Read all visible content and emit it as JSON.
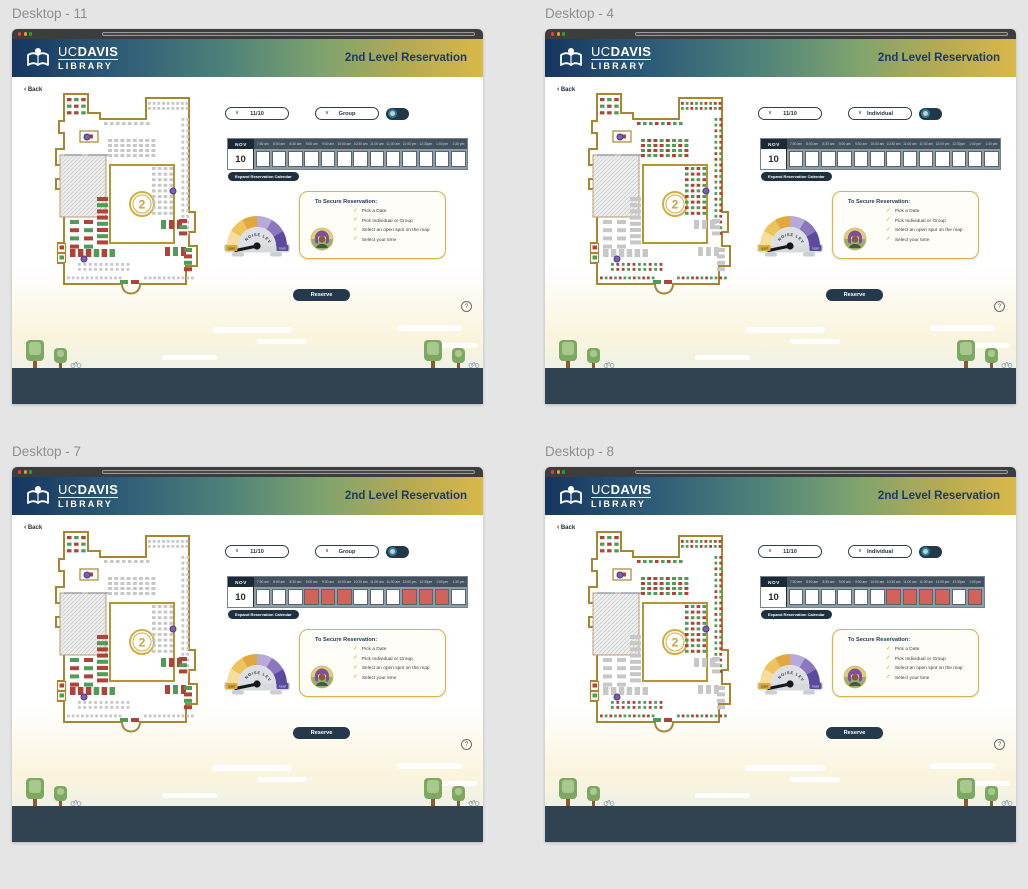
{
  "canvas": {
    "background": "#e5e5e5"
  },
  "frames": [
    {
      "label": "Desktop - 11",
      "date": "11/10",
      "mode": "Group",
      "map_mode": "group",
      "calendar": {
        "month": "NOV",
        "day": "10",
        "times": [
          "7:30 am",
          "8:00 am",
          "8:30 am",
          "9:00 am",
          "9:30 am",
          "10:00 am",
          "10:30 am",
          "11:00 am",
          "11:30 am",
          "12:00 pm",
          "12:30pm",
          "1:00 pm",
          "1:30 pm"
        ],
        "slots": [
          "open",
          "open",
          "open",
          "open",
          "open",
          "open",
          "open",
          "open",
          "open",
          "open",
          "open",
          "open",
          "open"
        ]
      }
    },
    {
      "label": "Desktop - 4",
      "date": "11/10",
      "mode": "Individual",
      "map_mode": "individual",
      "calendar": {
        "month": "NOV",
        "day": "10",
        "times": [
          "7:30 am",
          "8:00 am",
          "8:30 am",
          "9:00 am",
          "9:30 am",
          "10:00 am",
          "10:30 am",
          "11:00 am",
          "11:30 am",
          "12:00 pm",
          "12:30pm",
          "1:00 pm",
          "1:30 pm"
        ],
        "slots": [
          "open",
          "open",
          "open",
          "open",
          "open",
          "open",
          "open",
          "open",
          "open",
          "open",
          "open",
          "open",
          "open"
        ]
      }
    },
    {
      "label": "Desktop - 7",
      "date": "11/10",
      "mode": "Group",
      "map_mode": "group",
      "calendar": {
        "month": "NOV",
        "day": "10",
        "times": [
          "7:30 am",
          "8:00 am",
          "8:30 am",
          "9:00 am",
          "9:30 am",
          "10:00 am",
          "10:30 am",
          "11:00 am",
          "11:30 am",
          "12:00 pm",
          "12:30pm",
          "1:00 pm",
          "1:30 pm"
        ],
        "slots": [
          "open",
          "open",
          "open",
          "booked",
          "booked",
          "booked",
          "open",
          "open",
          "open",
          "booked",
          "booked",
          "booked",
          "open"
        ]
      }
    },
    {
      "label": "Desktop - 8",
      "date": "11/10",
      "mode": "Individual",
      "map_mode": "individual",
      "calendar": {
        "month": "NOV",
        "day": "10",
        "times": [
          "7:30 am",
          "8:00 am",
          "8:30 am",
          "9:00 am",
          "9:30 am",
          "10:00 am",
          "10:30 am",
          "11:00 am",
          "11:30 am",
          "12:00 pm",
          "12:30pm",
          "1:00 pm"
        ],
        "slots": [
          "open",
          "open",
          "open",
          "open",
          "open",
          "open",
          "booked",
          "booked",
          "booked",
          "booked",
          "open",
          "booked"
        ]
      }
    }
  ],
  "shared": {
    "header": {
      "brand_top_regular": "UC",
      "brand_top_bold": "DAVIS",
      "brand_bottom": "LIBRARY",
      "page_title": "2nd Level Reservation"
    },
    "back": {
      "chevron": "‹",
      "label": "Back"
    },
    "controls": {
      "chevron": "∨"
    },
    "calendar_expand_label": "Expand Reservation Calendar",
    "gauge": {
      "title": "NOISE LEVEL",
      "min_label": "quiet",
      "max_label": "loud"
    },
    "instructions": {
      "title": "To Secure Reservation:",
      "check_glyph": "✓",
      "items": [
        "Pick a Date",
        "Pick Individual or Group",
        "Select an open spot on the map",
        "Select your time"
      ]
    },
    "reserve_label": "Reserve",
    "help_glyph": "?",
    "map_level": "2"
  },
  "colors": {
    "header_gradient": [
      "#16365f",
      "#4f8379",
      "#d9b84a"
    ],
    "accent_navy": "#24394b",
    "gold_border": "#d8b349",
    "booked_slot": "#d2635b",
    "seat_open": "#4f9c57",
    "seat_taken": "#b04237",
    "seat_unavailable": "#c7c7c7",
    "marker_purple": "#7b5fb5",
    "gauge_yellows": [
      "#f6dd9b",
      "#eec35c",
      "#e2a83e"
    ],
    "gauge_purples": [
      "#b7a9d8",
      "#8a77bd",
      "#5c4a9f"
    ],
    "traffic_lights": [
      "#e0443e",
      "#dfa123",
      "#25a52f"
    ]
  },
  "map": {
    "seat_colors": {
      "r": "#b04237",
      "g": "#4f9c57",
      "x": "#c7c7c7"
    },
    "markers": [
      {
        "x": 53,
        "y": 46
      },
      {
        "x": 139,
        "y": 100
      },
      {
        "x": 50,
        "y": 168
      }
    ],
    "clusters": [
      {
        "name": "tab-cluster",
        "cat": "always",
        "x": 33,
        "y": 7,
        "cols": 3,
        "rows": 3,
        "w": 4.5,
        "h": 3.2,
        "gx": 2.6,
        "gy": 3.4,
        "pat": "rgrgrgrrg"
      },
      {
        "name": "closet-seat",
        "cat": "always",
        "x": 50,
        "y": 43.5,
        "cols": 1,
        "rows": 1,
        "w": 9,
        "h": 4,
        "gx": 0,
        "gy": 0,
        "pat": "r"
      },
      {
        "name": "elevator-seats",
        "cat": "always",
        "x": 25.5,
        "y": 154.5,
        "cols": 1,
        "rows": 2,
        "w": 4.5,
        "h": 4,
        "gx": 0,
        "gy": 6,
        "pat": "rg"
      },
      {
        "name": "top-row",
        "cat": "individual",
        "x": 114,
        "y": 11,
        "cols": 9,
        "rows": 2,
        "w": 2.8,
        "h": 2.8,
        "gx": 1.9,
        "gy": 2.2,
        "pat": "rgrggrgrrggrgrgrgr"
      },
      {
        "name": "upper-row",
        "cat": "individual",
        "x": 70,
        "y": 31,
        "cols": 8,
        "rows": 1,
        "w": 3.6,
        "h": 3,
        "gx": 2.4,
        "gy": 0,
        "pat": "rggrgrgg"
      },
      {
        "name": "right-col",
        "cat": "individual",
        "x": 147.5,
        "y": 27,
        "cols": 2,
        "rows": 21,
        "w": 2.8,
        "h": 2.8,
        "gx": 2,
        "gy": 2.9,
        "pat": "grgrrggrgrgrrgrggrgrrggrgrgrrggrgrgrgrrggr"
      },
      {
        "name": "center-grid",
        "cat": "individual",
        "x": 74,
        "y": 48,
        "cols": 8,
        "rows": 4,
        "w": 4,
        "h": 3,
        "gx": 2.2,
        "gy": 2,
        "pat": "grrgrgggrgrrggrggrrgrggrrggrgrgr"
      },
      {
        "name": "center-right-grid",
        "cat": "individual",
        "x": 118,
        "y": 76,
        "cols": 4,
        "rows": 9,
        "w": 3.6,
        "h": 3,
        "gx": 2.2,
        "gy": 2.6,
        "pat": "rgrggrrgrggrgrrggrgrrgrggrrgrggrgrrg"
      },
      {
        "name": "bottom-dots",
        "cat": "individual",
        "x": 44,
        "y": 172,
        "cols": 10,
        "rows": 2,
        "w": 2.8,
        "h": 2.8,
        "gx": 2.6,
        "gy": 2.2,
        "pat": "grgrrggrgrgrrgrggrgr"
      },
      {
        "name": "bottom-edge-left",
        "cat": "individual",
        "x": 33,
        "y": 185.5,
        "cols": 12,
        "rows": 1,
        "w": 2.8,
        "h": 2.8,
        "gx": 1.9,
        "gy": 0,
        "pat": "rgrgrggrgrrg"
      },
      {
        "name": "bottom-edge-right",
        "cat": "individual",
        "x": 110,
        "y": 185.5,
        "cols": 11,
        "rows": 1,
        "w": 2.8,
        "h": 2.8,
        "gx": 1.9,
        "gy": 0,
        "pat": "grgrrgrggrg"
      },
      {
        "name": "left-stack",
        "cat": "group",
        "x": 36,
        "y": 129,
        "cols": 2,
        "rows": 4,
        "w": 9,
        "h": 4,
        "gx": 5,
        "gy": 4.2,
        "pat": "grrggrrg"
      },
      {
        "name": "mid-stack",
        "cat": "group",
        "x": 63,
        "y": 106,
        "cols": 1,
        "rows": 8,
        "w": 11,
        "h": 4,
        "gx": 0,
        "gy": 2.2,
        "pat": "rgrrgrgr"
      },
      {
        "name": "bottom-left-row",
        "cat": "group",
        "x": 36,
        "y": 158,
        "cols": 6,
        "rows": 1,
        "w": 5.5,
        "h": 8,
        "gx": 2.4,
        "gy": 0,
        "pat": "rrrgrg"
      },
      {
        "name": "right-mid-bars",
        "cat": "group",
        "x": 127,
        "y": 129,
        "cols": 3,
        "rows": 1,
        "w": 5,
        "h": 9,
        "gx": 3,
        "gy": 0,
        "pat": "grr"
      },
      {
        "name": "right-mid-side",
        "cat": "group",
        "x": 145,
        "y": 128,
        "cols": 1,
        "rows": 3,
        "w": 8,
        "h": 4,
        "gx": 0,
        "gy": 2.2,
        "pat": "rgr"
      },
      {
        "name": "right-bottom-bars",
        "cat": "group",
        "x": 131,
        "y": 156,
        "cols": 3,
        "rows": 1,
        "w": 5,
        "h": 9,
        "gx": 3,
        "gy": 0,
        "pat": "rgr"
      },
      {
        "name": "right-bottom-side",
        "cat": "group",
        "x": 150,
        "y": 157,
        "cols": 1,
        "rows": 4,
        "w": 8,
        "h": 4,
        "gx": 0,
        "gy": 2.4,
        "pat": "grgr"
      },
      {
        "name": "entrance-seats",
        "cat": "always",
        "x": 86,
        "y": 189,
        "cols": 2,
        "rows": 1,
        "w": 8,
        "h": 4,
        "gx": 3,
        "gy": 0,
        "pat": "gr"
      }
    ]
  }
}
